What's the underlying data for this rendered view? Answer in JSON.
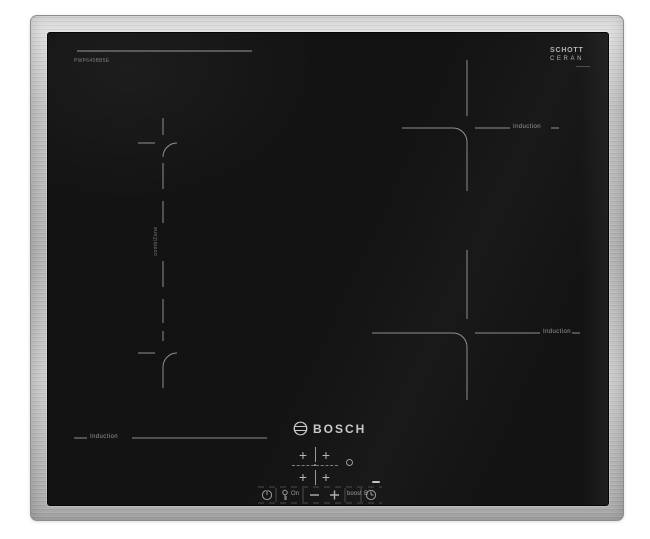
{
  "product": {
    "type_label": "induction-hob-product-photo",
    "brand_logo_text": "BOSCH",
    "glass_brand": {
      "line1": "SCHOTT",
      "line2": "CERAN"
    },
    "model_text": "PWP645BB5E",
    "zones": {
      "top_right_label": "Induction",
      "bottom_right_label": "Induction",
      "bottom_left_label": "Induction",
      "flex_vertical_label": "combiZone"
    },
    "control_panel": {
      "zone_select_plus": "+",
      "lock_on_label": "On",
      "minus_label": "–",
      "plus_label": "+",
      "boost_label": "boost",
      "boost_level_label": "B",
      "icons": [
        "power-icon",
        "key-lock-icon",
        "timer-icon",
        "bosch-anchor-icon"
      ]
    },
    "colors": {
      "frame_light": "#e3e3e3",
      "frame_dark": "#a8a8a8",
      "glass": "#131313",
      "marking": "#8f8f8f",
      "label_text": "#9a9a9a",
      "logo_text": "#c9c9c9"
    }
  }
}
